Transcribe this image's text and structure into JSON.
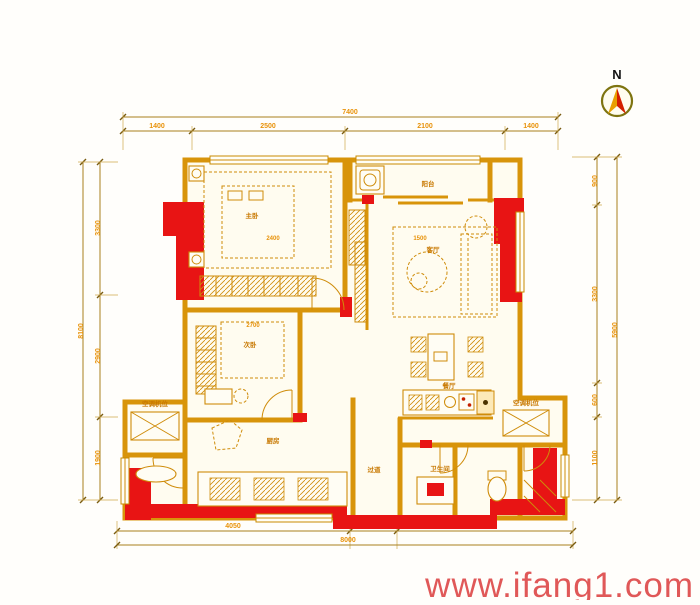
{
  "watermark": "www.ifang1.com",
  "compass": {
    "north_label": "N"
  },
  "dimensions": {
    "top": {
      "overall": "7400",
      "segments": [
        "1400",
        "2500",
        "2100",
        "1400"
      ]
    },
    "bottom": {
      "overall": "8000",
      "segments": [
        "4050",
        "1100",
        "2850"
      ]
    },
    "left": {
      "overall": "8100",
      "segments": [
        "3300",
        "2900",
        "1900"
      ]
    },
    "right": {
      "overall": "5900",
      "segments": [
        "900",
        "3300",
        "600",
        "1100"
      ]
    }
  },
  "rooms": {
    "master_bedroom": "主卧",
    "second_bedroom": "次卧",
    "living_room": "客厅",
    "dining": "餐厅",
    "kitchen": "厨房",
    "bathroom": "卫生间",
    "balcony": "阳台",
    "hallway": "过道",
    "ac_platform_left": "空调机位",
    "ac_platform_right": "空调机位"
  },
  "inline_dims": {
    "master_bed": "2400",
    "living_sofa": "1500",
    "second_bed": "2700"
  },
  "colors": {
    "wall": "#d8940a",
    "shear_wall": "#e81414",
    "dim_text": "#e8920a",
    "watermark": "#e05858"
  }
}
